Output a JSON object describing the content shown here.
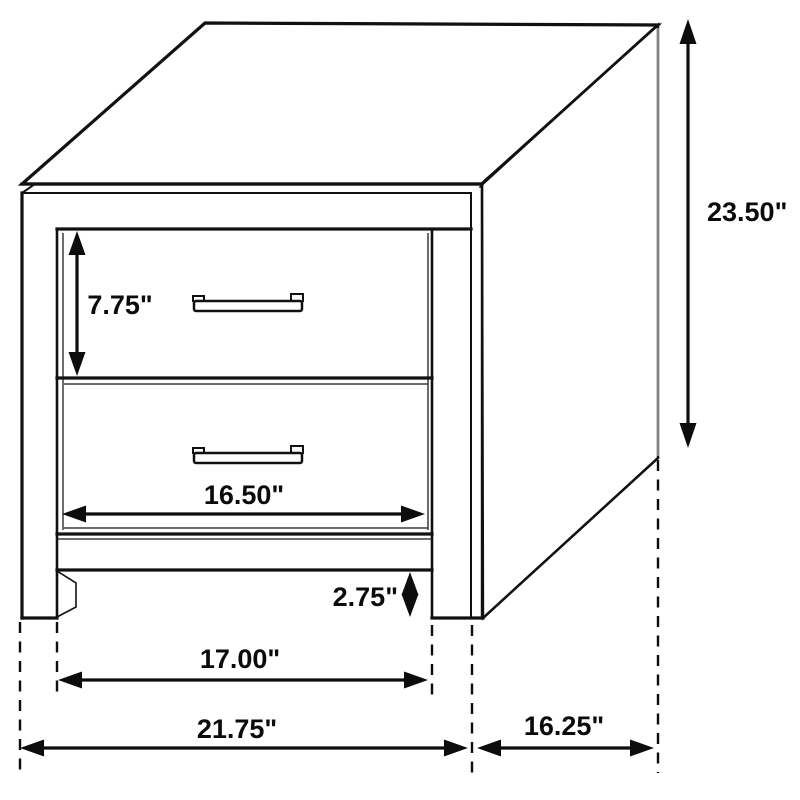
{
  "diagram": {
    "type": "furniture-dimension-drawing",
    "subject": "two-drawer nightstand",
    "background_color": "#ffffff",
    "line_color": "#111111",
    "labels": {
      "overall_height": "23.50\"",
      "top_drawer_height": "7.75\"",
      "drawer_width": "16.50\"",
      "base_clearance": "2.75\"",
      "inner_leg_span": "17.00\"",
      "overall_width": "21.75\"",
      "side_depth": "16.25\""
    }
  }
}
